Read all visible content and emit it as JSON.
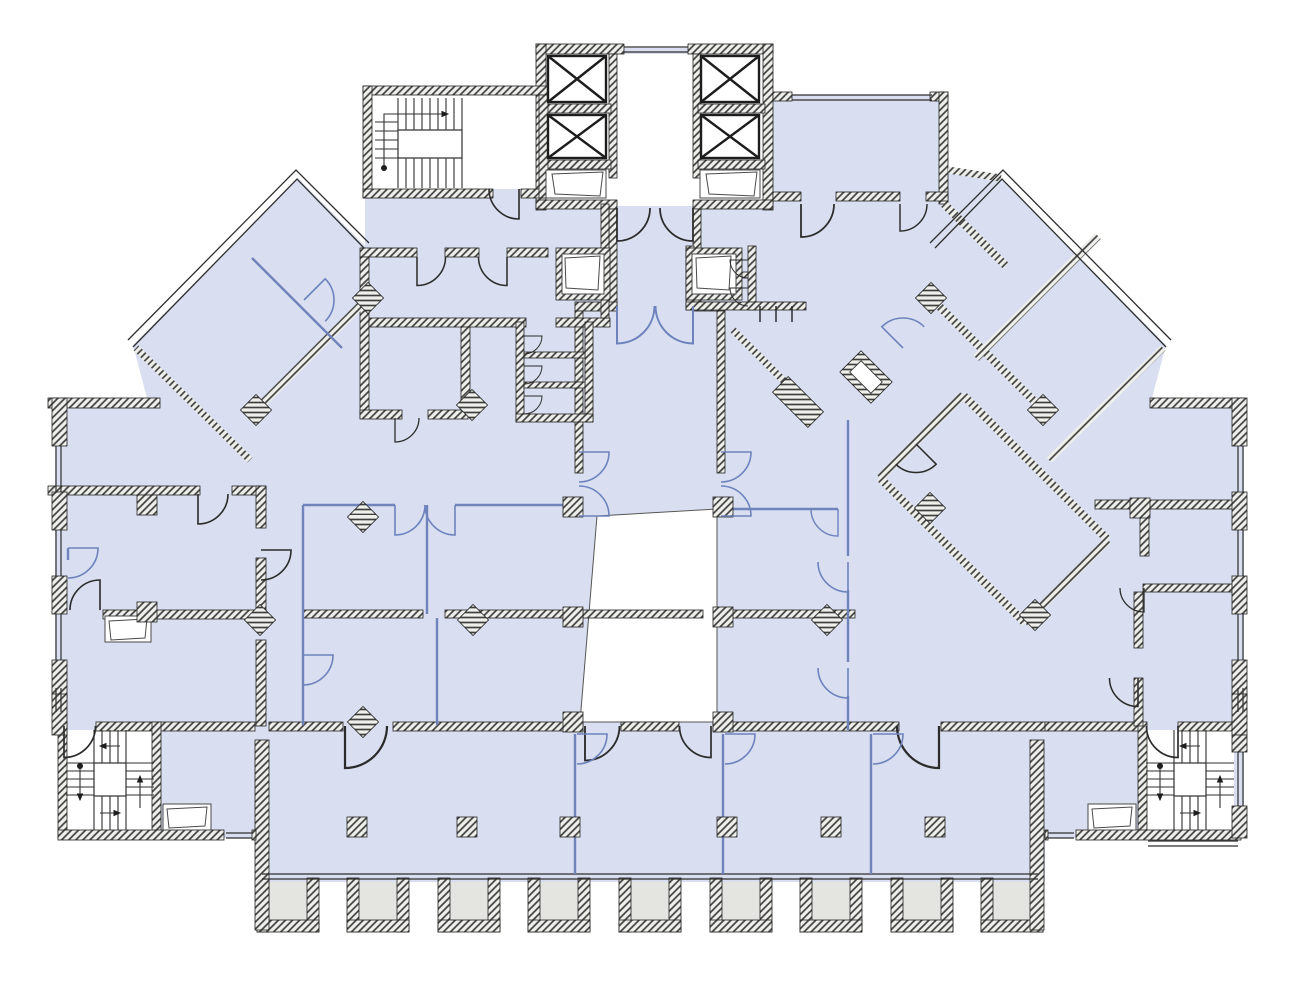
{
  "drawing": {
    "kind": "architectural-floor-plan",
    "colors": {
      "background": "#ffffff",
      "room_fill": "#d9dff0",
      "void_fill": "#ffffff",
      "balcony_fill": "#e4e4e0",
      "hatch_bg": "#efefeb",
      "hatch_line": "#3f3f3f",
      "wall_line": "#1d1d1d",
      "partition_blue": "#7183bb",
      "door_black": "#2b2b2b",
      "door_blue": "#6e83bd",
      "window_line": "#2e2e2e",
      "fixture_line": "#4a4a4a",
      "stair_line": "#2f2f2f"
    },
    "inventory": {
      "elevator_shafts": 4,
      "stairwells": 3,
      "balconies": 9,
      "square_columns": 15,
      "diamond_columns": 12,
      "wings": 2,
      "duct_shafts": 8,
      "toilet_stalls": 5,
      "central_voids": 1
    }
  }
}
